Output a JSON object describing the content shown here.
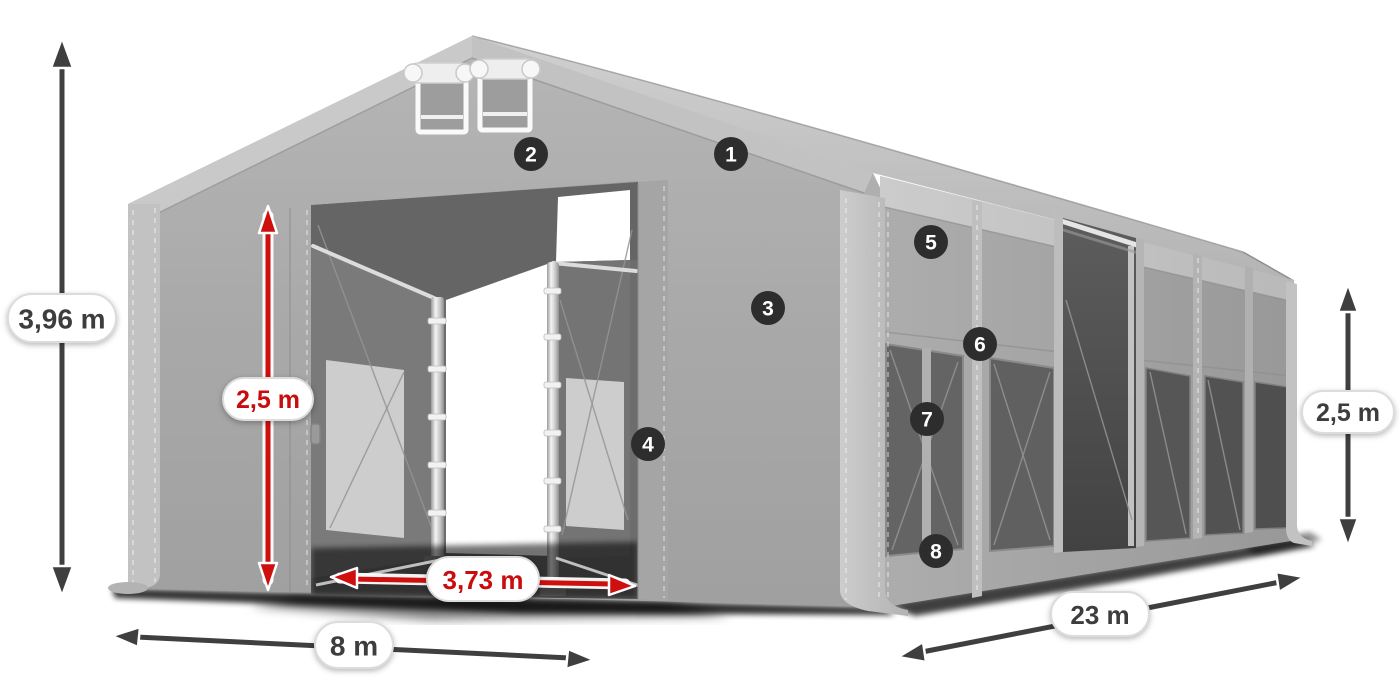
{
  "dimensions": {
    "total_height": {
      "label": "3,96 m",
      "accent": "gray"
    },
    "entrance_height": {
      "label": "2,5 m",
      "accent": "red"
    },
    "entrance_width": {
      "label": "3,73 m",
      "accent": "red"
    },
    "gable_width": {
      "label": "8 m",
      "accent": "gray"
    },
    "length": {
      "label": "23 m",
      "accent": "gray"
    },
    "side_wall_height": {
      "label": "2,5 m",
      "accent": "gray"
    }
  },
  "markers": [
    {
      "label": "1"
    },
    {
      "label": "2"
    },
    {
      "label": "3"
    },
    {
      "label": "4"
    },
    {
      "label": "5"
    },
    {
      "label": "6"
    },
    {
      "label": "7"
    },
    {
      "label": "8"
    }
  ],
  "colors": {
    "dimension_red": "#cf0e0e",
    "dimension_gray": "#3f3f3f",
    "marker_background": "#2d2d2d",
    "marker_text": "#ffffff",
    "fabric_gray": "#a8a8a8",
    "background": "#ffffff"
  }
}
